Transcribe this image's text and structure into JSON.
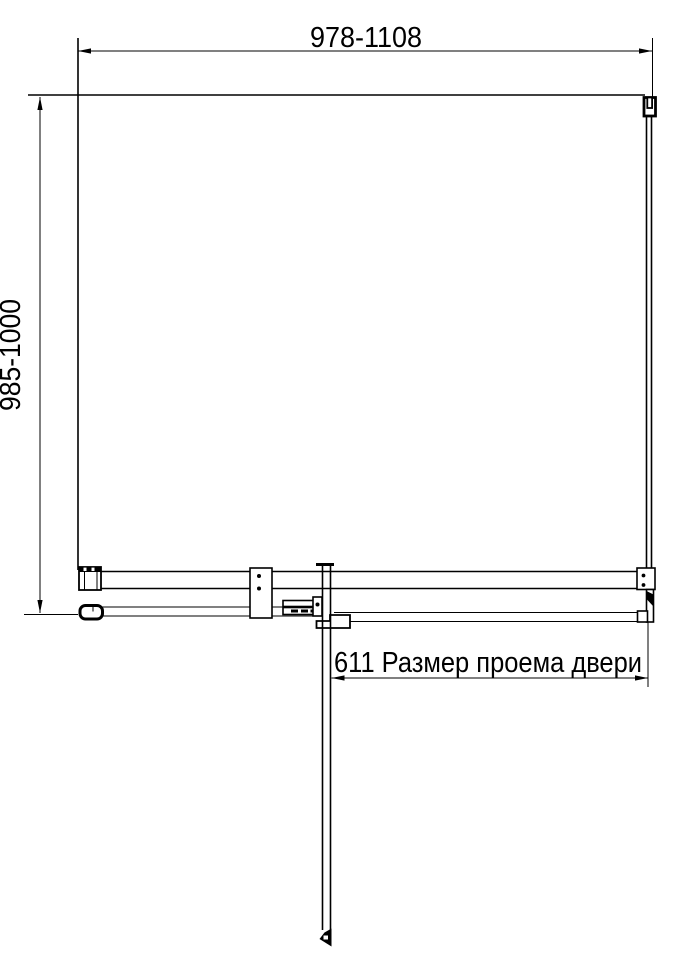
{
  "drawing": {
    "type": "technical-dimension-drawing",
    "subject": "shower-door-top-view",
    "dimensions": {
      "width_range": "978-1108",
      "height_range": "985-1000",
      "door_opening": "611 Размер проема двери"
    },
    "colors": {
      "line": "#000000",
      "background": "#ffffff"
    }
  }
}
